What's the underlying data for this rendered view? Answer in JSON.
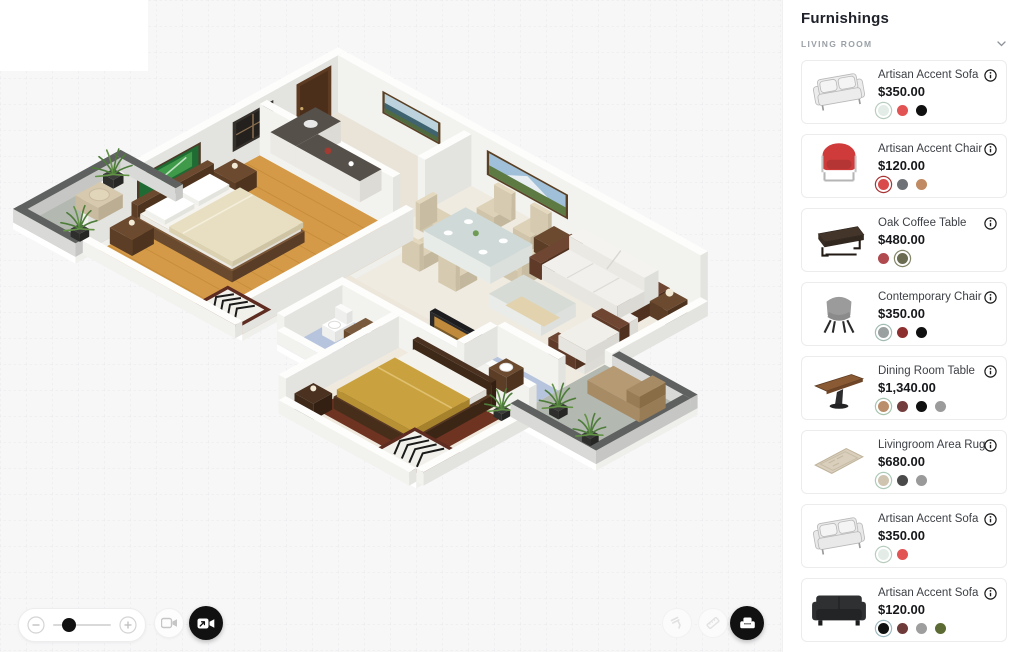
{
  "canvas": {
    "grid_color": "#e9e9eb",
    "logo_placeholder": true
  },
  "toolbar": {
    "zoom_percent": 28,
    "buttons": [
      {
        "name": "zoom-out"
      },
      {
        "name": "zoom-slider"
      },
      {
        "name": "zoom-in"
      },
      {
        "name": "view-2d-camera",
        "active": false
      },
      {
        "name": "view-3d-camera",
        "active": true
      },
      {
        "name": "paint-roller",
        "active": false
      },
      {
        "name": "measure-ruler",
        "active": false
      },
      {
        "name": "furniture",
        "active": true
      }
    ]
  },
  "sidebar": {
    "title": "Furnishings",
    "category": {
      "label": "LIVING ROOM",
      "chevron_icon": "chevron-down"
    },
    "products": [
      {
        "name": "Artisan Accent Sofa",
        "price": "$350.00",
        "thumb": "sofa",
        "thumb_color": "#ececec",
        "swatches": [
          {
            "color": "#e3ece6",
            "selected": true,
            "ring": "#b9cdbf"
          },
          {
            "color": "#e25353"
          },
          {
            "color": "#101010"
          }
        ]
      },
      {
        "name": "Artisan Accent Chair",
        "price": "$120.00",
        "thumb": "tub-chair",
        "thumb_color": "#cf3b3b",
        "swatches": [
          {
            "color": "#d94a4a",
            "selected": true,
            "ring": "#a83434"
          },
          {
            "color": "#6e7276"
          },
          {
            "color": "#c08a62"
          }
        ]
      },
      {
        "name": "Oak Coffee Table",
        "price": "$480.00",
        "thumb": "coffee-table",
        "thumb_color": "#44352a",
        "swatches": [
          {
            "color": "#b04a4f"
          },
          {
            "color": "#6b6b52",
            "selected": true,
            "ring": "#85856a"
          }
        ]
      },
      {
        "name": "Contemporary Chair",
        "price": "$350.00",
        "thumb": "modern-chair",
        "thumb_color": "#9b9b9b",
        "swatches": [
          {
            "color": "#9aa0a0",
            "selected": true,
            "ring": "#a2bcb2"
          },
          {
            "color": "#8e2f2f"
          },
          {
            "color": "#101010"
          }
        ]
      },
      {
        "name": "Dining Room Table",
        "price": "$1,340.00",
        "thumb": "dining-table",
        "thumb_color": "#8a5a35",
        "swatches": [
          {
            "color": "#bb8e6b",
            "selected": true,
            "ring": "#a8c4ae"
          },
          {
            "color": "#733d3d"
          },
          {
            "color": "#101010"
          },
          {
            "color": "#9b9b9b"
          }
        ]
      },
      {
        "name": "Livingroom Area Rug",
        "price": "$680.00",
        "thumb": "rug",
        "thumb_color": "#d9cfbc",
        "swatches": [
          {
            "color": "#cfc4b0",
            "selected": true,
            "ring": "#accab8"
          },
          {
            "color": "#4a4a4a"
          },
          {
            "color": "#9a9a9a"
          }
        ]
      },
      {
        "name": "Artisan Accent Sofa",
        "price": "$350.00",
        "thumb": "sofa",
        "thumb_color": "#e9e9e9",
        "swatches": [
          {
            "color": "#e3ece6",
            "selected": true,
            "ring": "#b9cdbf"
          },
          {
            "color": "#e25353"
          }
        ]
      },
      {
        "name": "Artisan Accent Sofa",
        "price": "$120.00",
        "thumb": "sofa-front",
        "thumb_color": "#2e3032",
        "swatches": [
          {
            "color": "#101010",
            "selected": true,
            "ring": "#9fbac1"
          },
          {
            "color": "#6e3a3a"
          },
          {
            "color": "#9e9e9e"
          },
          {
            "color": "#5c6b34"
          }
        ]
      }
    ]
  }
}
